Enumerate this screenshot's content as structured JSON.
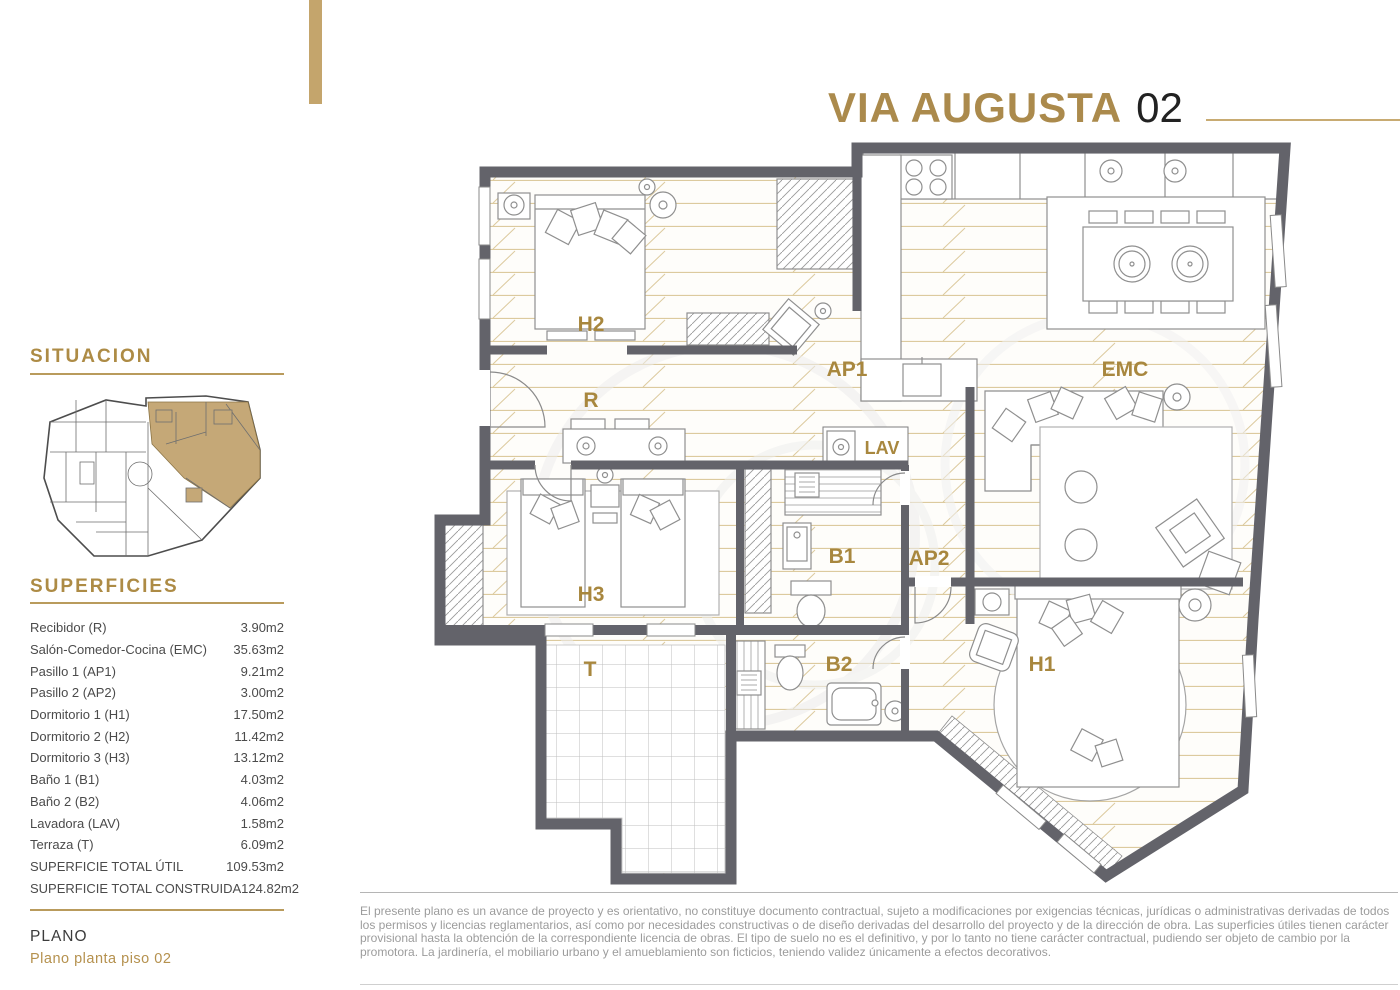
{
  "header": {
    "title": "VIA AUGUSTA",
    "unit": "02"
  },
  "sidebar": {
    "situacion_heading": "SITUACION",
    "superficies_heading": "SUPERFICIES",
    "rows": [
      {
        "label": "Recibidor (R)",
        "value": "3.90m2"
      },
      {
        "label": "Salón-Comedor-Cocina (EMC)",
        "value": "35.63m2"
      },
      {
        "label": "Pasillo 1 (AP1)",
        "value": "9.21m2"
      },
      {
        "label": "Pasillo 2 (AP2)",
        "value": "3.00m2"
      },
      {
        "label": "Dormitorio 1 (H1)",
        "value": "17.50m2"
      },
      {
        "label": "Dormitorio 2 (H2)",
        "value": "11.42m2"
      },
      {
        "label": "Dormitorio 3 (H3)",
        "value": "13.12m2"
      },
      {
        "label": "Baño 1 (B1)",
        "value": "4.03m2"
      },
      {
        "label": "Baño 2 (B2)",
        "value": "4.06m2"
      },
      {
        "label": "Lavadora (LAV)",
        "value": "1.58m2"
      },
      {
        "label": "Terraza (T)",
        "value": "6.09m2"
      },
      {
        "label": "SUPERFICIE TOTAL ÚTIL",
        "value": "109.53m2"
      },
      {
        "label": "SUPERFICIE TOTAL CONSTRUIDA",
        "value": "124.82m2"
      }
    ],
    "plano_heading": "PLANO",
    "plano_subtitle": "Plano planta piso 02"
  },
  "plan": {
    "room_labels": [
      {
        "id": "h2",
        "text": "H2"
      },
      {
        "id": "r",
        "text": "R"
      },
      {
        "id": "ap1",
        "text": "AP1"
      },
      {
        "id": "emc",
        "text": "EMC"
      },
      {
        "id": "lav",
        "text": "LAV"
      },
      {
        "id": "b1",
        "text": "B1"
      },
      {
        "id": "ap2",
        "text": "AP2"
      },
      {
        "id": "h3",
        "text": "H3"
      },
      {
        "id": "t",
        "text": "T"
      },
      {
        "id": "b2",
        "text": "B2"
      },
      {
        "id": "h1",
        "text": "H1"
      }
    ]
  },
  "footer": {
    "disclaimer": "El presente plano es un avance de proyecto y es orientativo, no constituye documento contractual, sujeto a modificaciones por exigencias técnicas, jurídicas o administrativas derivadas de todos los permisos y licencias reglamentarios, así como por necesidades constructivas o de diseño derivadas del desarrollo del proyecto y de la dirección de obra. Las superficies útiles tienen carácter provisional hasta la obtención de la correspondiente licencia de obras. El tipo de suelo no es el definitivo, y por lo tanto no tiene carácter contractual, pudiendo ser objeto de cambio por la promotora. La jardinería, el mobiliario urbano y el amueblamiento son ficticios, teniendo validez únicamente a efectos decorativos."
  },
  "colors": {
    "brand_gold": "#ab8a4c",
    "label_gold": "#a8873e",
    "wall_gray": "#63636a",
    "plank_tan": "#dcca9e",
    "body_text": "#4b4b4b",
    "muted_text": "#9c9c9c"
  }
}
